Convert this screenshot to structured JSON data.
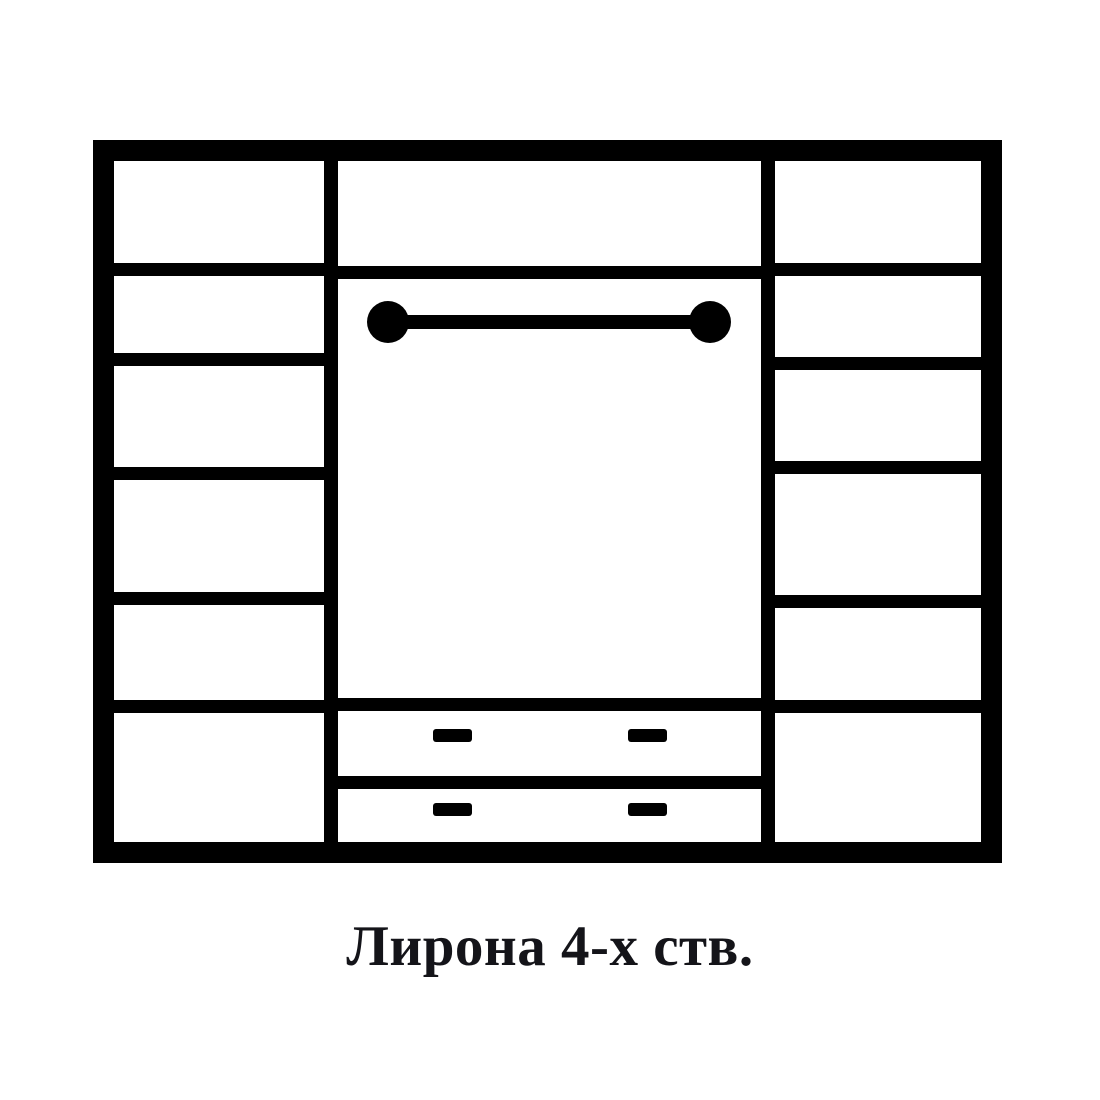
{
  "page": {
    "background": "#ffffff"
  },
  "caption": {
    "text": "Лирона 4-х ств.",
    "color": "#141419"
  },
  "diagram": {
    "type": "furniture-front-schematic",
    "subject": "4-door wardrobe front view with side shelves, hanging rod and two drawers",
    "line_color": "#000000",
    "panel_fill": "#ffffff",
    "frame": {
      "x": 93,
      "y": 140,
      "w": 909,
      "h": 723,
      "border": 21
    },
    "dividers": {
      "xs": [
        324,
        761
      ],
      "w": 14
    },
    "shelf_thickness": 13,
    "left_column": {
      "shelf_ys": [
        263,
        353,
        467,
        592,
        700
      ],
      "compartments": 6
    },
    "right_column": {
      "shelf_ys": [
        263,
        357,
        461,
        595,
        700
      ],
      "compartments": 6
    },
    "middle_column": {
      "top_shelf_y": 266,
      "hanging_rod": {
        "x1": 388,
        "x2": 710,
        "y_center": 322,
        "bar_h": 14,
        "end_r": 21
      },
      "drawer_line_ys": [
        698,
        776
      ],
      "drawer_handles": {
        "w": 39,
        "h": 13,
        "xs": [
          433,
          628
        ],
        "ys": [
          729,
          803
        ]
      }
    }
  }
}
